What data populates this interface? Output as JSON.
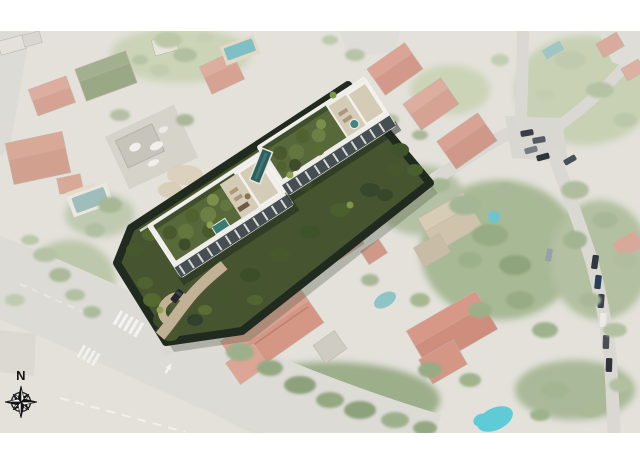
{
  "compass": {
    "north_label": "N",
    "color": "#161616"
  },
  "palette": {
    "page_bg": "#ffffff",
    "photo_base": "#e3e1da",
    "road": "#dcdbd6",
    "road_secondary": "#dad8d2",
    "marking_white": "#f4f3ef",
    "villa_roof": "#d6a294",
    "salmon_roof": "#d49685",
    "construction": "#d6d3cb",
    "pool_faded": "#9fbdba",
    "pool_bright": "#5ecbd6",
    "parcel_green": "#46552f",
    "hedge_dark": "#202a1e",
    "building_white": "#eeede8",
    "roof_garden": "#57683a",
    "terrace_tan": "#d5ccb8",
    "lap_pool": "#2c5f5e",
    "driveway_tan": "#c2b295",
    "facade_dark": "#454e52"
  }
}
